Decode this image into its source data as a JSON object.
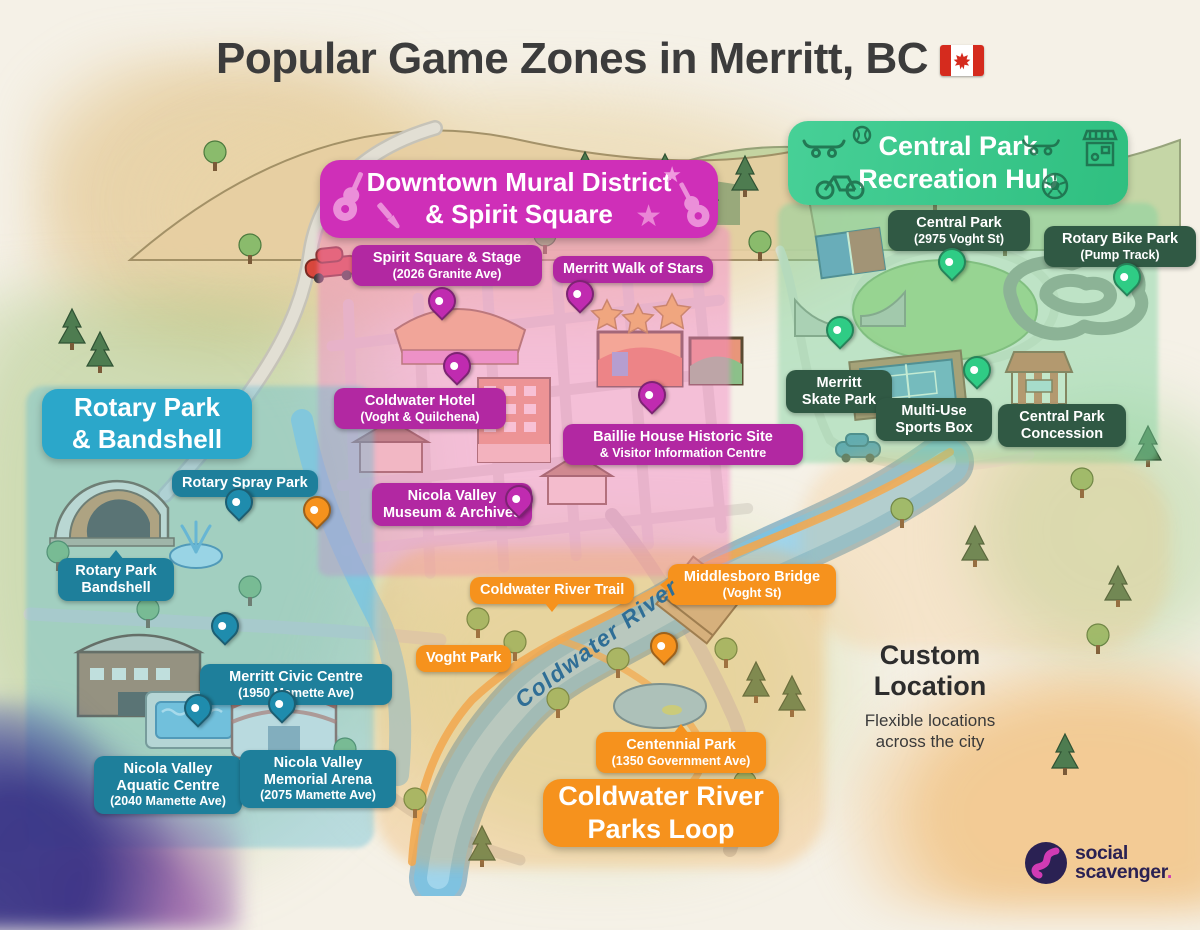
{
  "title": {
    "text": "Popular Game Zones in Merritt, BC",
    "flag_icon": "canada-flag"
  },
  "colors": {
    "downtown_banner": "#cf2fb8",
    "downtown_pill": "#b228a2",
    "downtown_pin": "#c02bb0",
    "central_banner": "#35c389",
    "central_pill": "#305944",
    "central_pin": "#2fcc85",
    "rotary_banner": "#2ba7ca",
    "rotary_pill": "#1e7f9b",
    "rotary_pin": "#1f8cad",
    "loop_banner": "#f6921d",
    "loop_pill": "#f6921d",
    "loop_pin": "#f6921d",
    "paper": "#f5f1e7",
    "river": "#7fc2e0",
    "title_text": "#3c3c3c"
  },
  "zones": {
    "downtown": {
      "banner": {
        "line1": "Downtown Mural District",
        "line2": "& Spirit Square",
        "icons": [
          "guitar",
          "paintbrush",
          "star",
          "star",
          "guitar"
        ]
      },
      "locations": {
        "spirit_square": {
          "name": "Spirit Square & Stage",
          "address": "(2026 Granite Ave)"
        },
        "walk_of_stars": {
          "name": "Merritt Walk of Stars"
        },
        "coldwater_hotel": {
          "name": "Coldwater Hotel",
          "address": "(Voght & Quilchena)"
        },
        "baillie_house": {
          "name": "Baillie House Historic Site",
          "address": "& Visitor Information Centre"
        },
        "museum": {
          "name": "Nicola Valley Museum & Archives"
        }
      }
    },
    "central_park": {
      "banner": {
        "line1": "Central Park",
        "line2": "Recreation Hub",
        "icons": [
          "skateboard",
          "baseball",
          "bicycle",
          "skateboard",
          "concession-stand",
          "soccer-ball"
        ]
      },
      "locations": {
        "central_park": {
          "name": "Central Park",
          "address": "(2975 Voght St)"
        },
        "bike_park": {
          "name": "Rotary Bike Park",
          "address": "(Pump Track)"
        },
        "skate_park": {
          "name": "Merritt Skate Park"
        },
        "sports_box": {
          "name": "Multi-Use Sports Box"
        },
        "concession": {
          "name": "Central Park Concession"
        }
      }
    },
    "rotary_park": {
      "banner": {
        "line1": "Rotary Park",
        "line2": "& Bandshell"
      },
      "locations": {
        "spray_park": {
          "name": "Rotary Spray Park"
        },
        "bandshell": {
          "name": "Rotary Park Bandshell"
        },
        "civic_centre": {
          "name": "Merritt Civic Centre",
          "address": "(1950 Mamette Ave)"
        },
        "aquatic_centre": {
          "name": "Nicola Valley Aquatic Centre",
          "address": "(2040 Mamette Ave)"
        },
        "arena": {
          "name": "Nicola Valley Memorial Arena",
          "address": "(2075 Mamette Ave)"
        }
      }
    },
    "coldwater_loop": {
      "banner": {
        "line1": "Coldwater River",
        "line2": "Parks Loop"
      },
      "locations": {
        "river_trail": {
          "name": "Coldwater River Trail"
        },
        "voght_park": {
          "name": "Voght Park"
        },
        "middlesboro_bridge": {
          "name": "Middlesboro Bridge",
          "address": "(Voght St)"
        },
        "centennial_park": {
          "name": "Centennial Park",
          "address": "(1350 Government Ave)"
        }
      }
    },
    "custom": {
      "title": "Custom Location",
      "subtitle": "Flexible locations across the city"
    }
  },
  "map": {
    "river_label": "Coldwater River"
  },
  "branding": {
    "logo_line1": "social",
    "logo_line2": "scavenger",
    "logo_period": "."
  }
}
